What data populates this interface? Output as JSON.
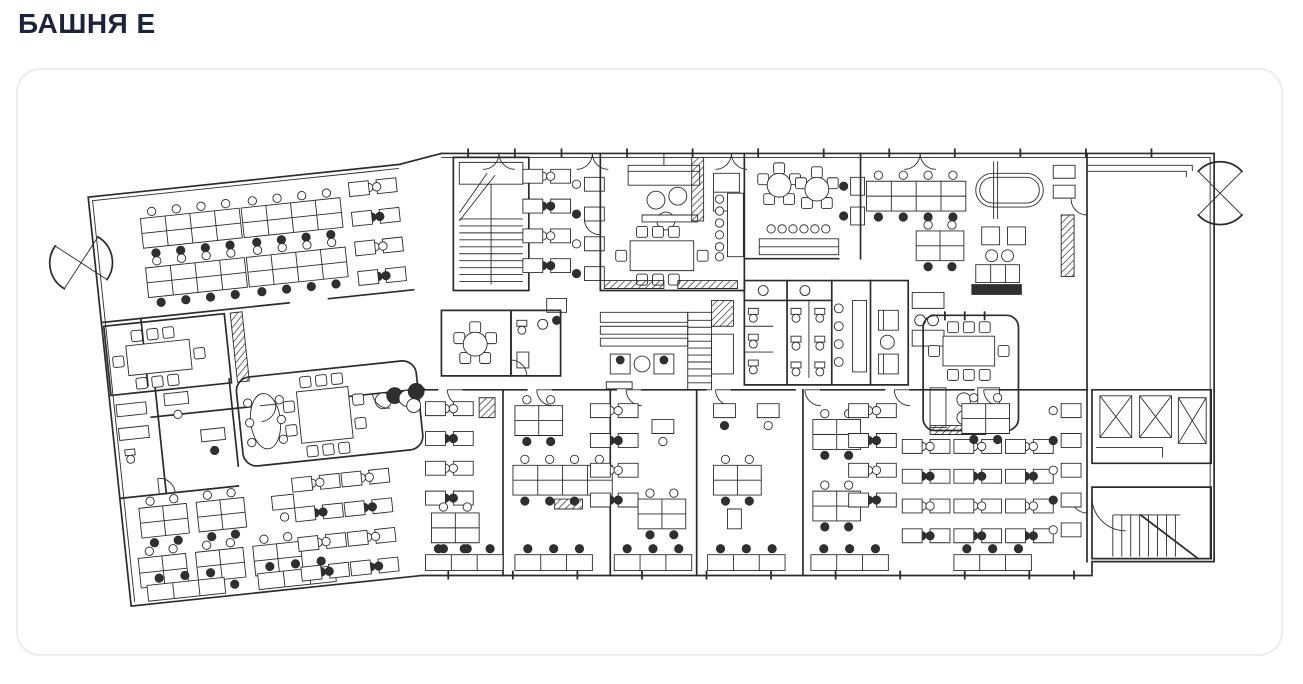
{
  "page": {
    "title": "БАШНЯ Е"
  },
  "colors": {
    "background": "#ffffff",
    "title_text": "#1b2438",
    "card_border": "#ededed",
    "plan_lines": "#2b2b2b",
    "plan_fill_dark": "#2f2f2f"
  }
}
